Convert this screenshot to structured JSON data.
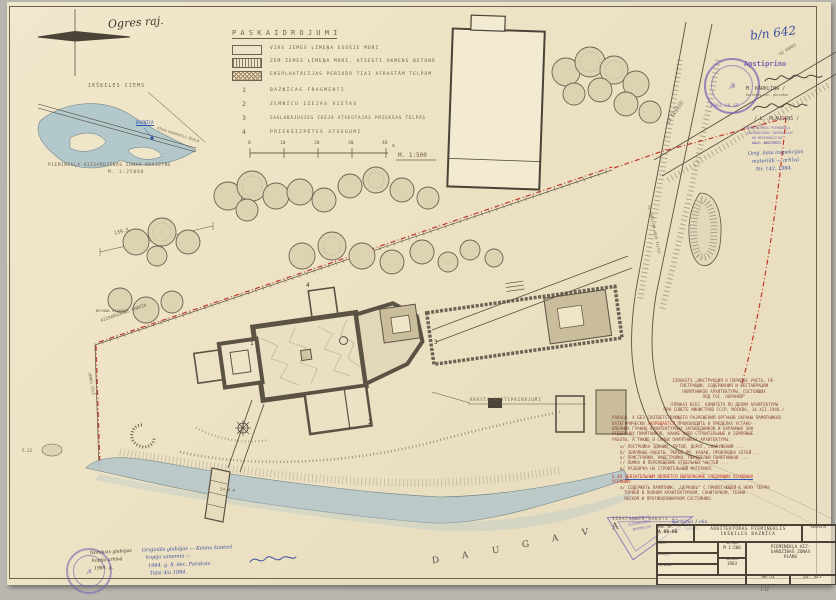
{
  "sheet": {
    "district_note": "Ogres raj.",
    "doc_number": "b/n 642"
  },
  "legend": {
    "title": "P A S K A I D R O J U M I",
    "swatches": [
      {
        "label": "VIRS ZEMES LĪMEŅA ESOŠIE MŪRI"
      },
      {
        "label": "ZEM ZEMES LĪMEŅA MŪRI, ATSEGTI AKMENS BETONĀ"
      },
      {
        "label": "EKSPLUATĀCIJAS PERIODĀ TIAI ATRASTĀM TELPĀM"
      }
    ],
    "numbered": [
      {
        "num": "1",
        "label": "BAZNĪCAS FRAGMENTI"
      },
      {
        "num": "2",
        "label": "ZEMNĪCU IZEJAS VIETAS"
      },
      {
        "num": "3",
        "label": "SAGLABĀJUSIES IEEJA ATSEGTAJĀS PRIEKŠAS TELPĀS"
      },
      {
        "num": "4",
        "label": "PRIEKŠIZPĒTES ATSEGUMI"
      }
    ],
    "scale": {
      "t0": "0",
      "t1": "10",
      "t2": "20",
      "t3": "30",
      "t4": "40",
      "unit": "m",
      "ratio": "M. 1:500"
    }
  },
  "inset": {
    "village": "IKŠĶILES CIEMS",
    "site": "BAZNĪCA",
    "road": "RĪGAS–DAUGAVPILS ŠOSEJA",
    "caption1": "PIEMINEKĻA AIZSARDZĪBAS ZONAS NOVIETNE",
    "caption2": "M. 1:25000"
  },
  "approve": {
    "word": "Apstiprinu",
    "name1": "M. KĀRKLIŅA /",
    "name1_sub": "Kultūras min. pārstāve",
    "date": "1963. 16. III",
    "name2": "/ L. PLAUCIŅŠ /",
    "office1": "ARHITEKTŪRAS PIEMINEKĻU",
    "office2": "AIZSARDZĪBAS INSPEKCIJAS",
    "office3": "UN RESTAURĀCIJAS",
    "office4": "GALV. ARHITEKTS"
  },
  "right_notes": {
    "line1": "Oriģ. lieta inspekcijas",
    "line2": "materiāli — arhīvā",
    "line3": "Nr. 142, 1984."
  },
  "plan": {
    "daugava": [
      "D",
      "A",
      "U",
      "G",
      "A",
      "V",
      "A"
    ],
    "labels": {
      "krasta": "KRASTA NOSTIPRINĀJUMI",
      "betona": "BETONA STABIŅI",
      "robeza": "AIZSARGZONAS ROBEŽA",
      "zemes_cels": "ZEMES CEĻŠ",
      "road_right": "UZ OGRI  /PA VECO TILTU/",
      "road_corner": "UZ OGRES",
      "hand_road": "uz Ikšķili",
      "dim1": "139.5",
      "dim2": "54.8 m",
      "spot": "5.22",
      "n1": "1",
      "n2": "2",
      "n3": "3",
      "n4": "4"
    }
  },
  "textblock": {
    "h1": "IZRAKSTS „ИНСТРУКЦИЯ О ПОРЯДКЕ УЧЕТА, РЕ-",
    "h2": "ГИСТРАЦИИ, СОДЕРЖАНИЯ И РЕСТАВРАЦИИ",
    "h3": "ПАМЯТНИКОВ АРХИТЕКТУРЫ, СОСТОЯЩИХ",
    "h4": "ПОД ГОС. ОХРАНОЙ“",
    "h5": "/ПРИКАЗ ВСЕС. КОМИТЕТА ПО ДЕЛАМ АРХИТЕКТУРЫ",
    "h6": "ПРИ СОВЕТЕ МИНИСТРОВ СССР, МОСКВА, 14.XII.1948./",
    "p_label": "PARAGR. X",
    "p1": "БЕЗ СООТВЕТСТВУЮЩЕГО РАЗРЕШЕНИЯ ОРГАНОВ ОХРАНЫ ПАМЯТНИКОВ",
    "p2a": "КАТЕГОРИЧЕСКИ ",
    "p2b": "ЗАПРЕЩАЕТСЯ",
    "p2c": " ПРОИЗВОДИТЬ В ПРЕДЕЛАХ УСТАНО-",
    "p3": "ВЛЕННЫХ ГРАНИЦ АРХИТЕКТУРНЫХ ЗАПОВЕДНИКОВ И ОХРАННЫХ ЗОН",
    "p4": "ОТДЕЛЬНЫХ ПАМЯТНИКОВ, КАКИЕ-ЛИБО СТРОИТЕЛЬНЫЕ И ЗЕМЛЯНЫЕ",
    "p5": "РАБОТЫ, А ТАКЖЕ В САМЫХ ПАМЯТНИКАХ АРХИТЕКТУРЫ:",
    "i1": "а/ ПОСТРОЙКА ЗДАНИЙ, ПУТЕЙ, ДОРОГ, СООРУЖЕНИЙ ...",
    "i2": "б/ ЗЕМЛЯНЫЕ РАБОТЫ, РЫТЬЁ ЯМ, КАНАВ, ПРОКЛАДКА СЕТЕЙ ...",
    "i3": "в/ ПРИСТРОЙКИ, НАДСТРОЙКИ, ПЕРЕДЕЛКИ ПАМЯТНИКОВ ...",
    "i4": "г/ ЛОМКА И ПЕРЕМЕЩЕНИЕ ОТДЕЛЬНЫХ ЧАСТЕЙ ...",
    "i5": "д/ РАЗБОРКА НА СТРОИТЕЛЬНЫЙ МАТЕРИАЛ.",
    "s_label": "§ 49",
    "s1": "ОБЯЗАТЕЛЬНЫМ ЯВЛЯЕТСЯ ВЫПОЛНЕНИЕ СЛЕДУЮЩИХ ОСНОВНЫХ",
    "s2": "УСЛОВИЙ:",
    "s3": "а/ СОДЕРЖАТЬ ПАМЯТНИК, „ЦЕРКОВЬ“ С ПРИЛЕГАЮЩЕЙ К НЕМУ ТЕРРИ-",
    "s4": "ТОРИЕЙ В ПОЛНОМ АРХИТЕКТУРНОМ, САНИТАРНОМ, ТЕХНИ-",
    "s5": "ЧЕСКОМ И ПРОТИВОПОЖАРНОМ СОСТОЯНИИ;",
    "made": "IZGATAVOTI RAKSTI 2:",
    "made_hw1": "Kārkliņai 1 eks.",
    "made_hw2": "2. Teksts."
  },
  "bottom_notes": {
    "black1": "Noraksts glabājas",
    "black2": "kopiju arhīvā",
    "black3": "1984. g.",
    "blue1": "Oriģināls glabājas — Kannu kantorī",
    "blue2": "kopija saņemta —",
    "blue3": "1984. g. 8. dec.   Paraksts",
    "blue4": "Talsi 4/a 1984."
  },
  "triangle_stamp": {
    "l1": "PIEMINEKĻU",
    "l2": "AIZSARDZĪBAS",
    "l3": "INSPEKCIJA"
  },
  "titleblock": {
    "proj_label": "Pas. Nr.",
    "proj_no": "A 80-60",
    "org1": "ARHITEKTŪRAS PIEMINEKLIS",
    "org2": "IKŠĶILES BAZNĪCA",
    "ctrl": "Kontrolē",
    "r1l": "Sast.",
    "r2l": "Zīmēja",
    "r3l": "Pārbaud.",
    "scale_l": "mērogs",
    "scale_v": "M 1:500",
    "date_l": "datums",
    "date_v": "1963",
    "title1": "PIEMINEKĻA AIZ-",
    "title2": "SARDZĪBAS ZONAS",
    "title3": "PLĀNS",
    "sheet_no": "AB-51",
    "sheet_p": "63. VII",
    "below": "VII"
  }
}
